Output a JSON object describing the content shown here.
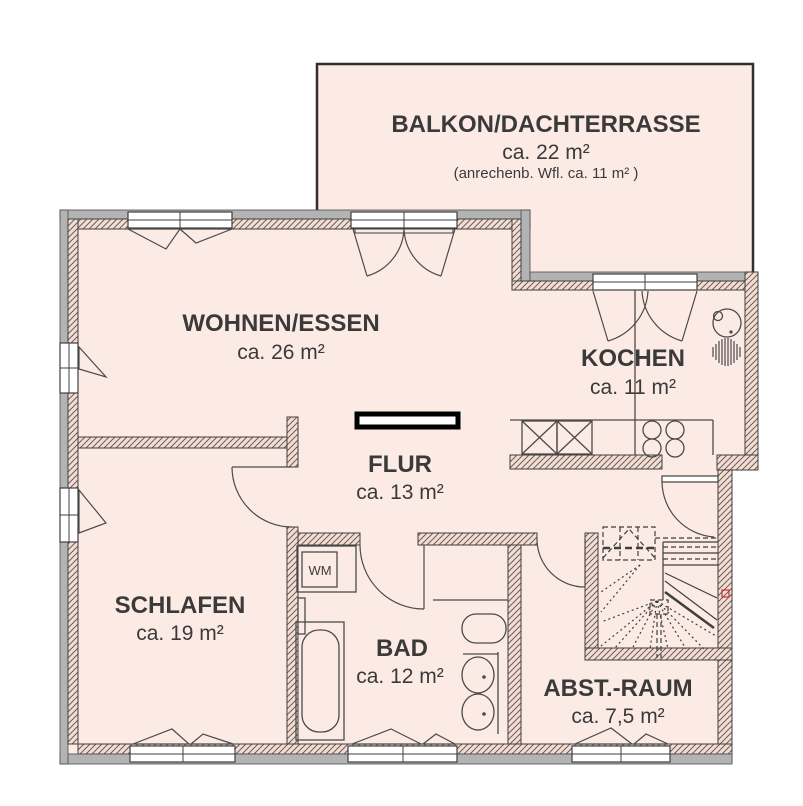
{
  "balcony": {
    "name": "BALKON/DACHTERRASSE",
    "area": "ca. 22 m²",
    "note": "(anrechenb. Wfl. ca. 11 m² )"
  },
  "rooms": {
    "wohnen": {
      "name": "WOHNEN/ESSEN",
      "area": "ca. 26 m²"
    },
    "kochen": {
      "name": "KOCHEN",
      "area": "ca. 11 m²"
    },
    "flur": {
      "name": "FLUR",
      "area": "ca. 13 m²"
    },
    "schlafen": {
      "name": "SCHLAFEN",
      "area": "ca. 19 m²"
    },
    "bad": {
      "name": "BAD",
      "area": "ca. 12 m²"
    },
    "abstellraum": {
      "name": "ABST.-RAUM",
      "area": "ca. 7,5 m²"
    }
  },
  "appliances": {
    "washing_machine_label": "WM"
  },
  "colors": {
    "floor": "#fcebe5",
    "wall_gray": "#b3b3b3",
    "hatch_line": "#6a5f57",
    "outline": "#3f3f3f",
    "text": "#3a3a3a",
    "marker_red": "#cc3333",
    "background": "#ffffff"
  }
}
